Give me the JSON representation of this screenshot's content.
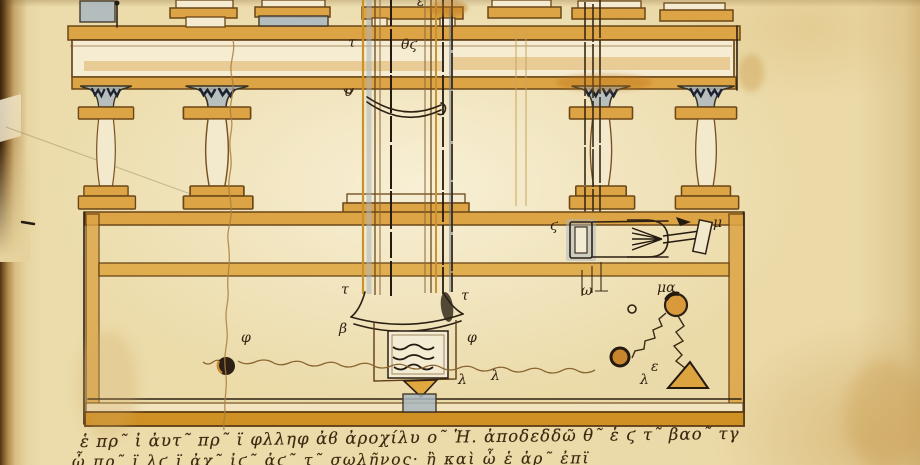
{
  "diagram_labels": [
    {
      "t": "τ",
      "x": 348,
      "y": 47
    },
    {
      "t": "θϛ",
      "x": 401,
      "y": 49
    },
    {
      "t": "ε",
      "x": 417,
      "y": 6
    },
    {
      "t": "υ",
      "x": 344,
      "y": 96
    },
    {
      "t": "ϛ",
      "x": 550,
      "y": 230
    },
    {
      "t": "μ",
      "x": 713,
      "y": 227
    },
    {
      "t": "ω",
      "x": 581,
      "y": 295
    },
    {
      "t": "μα",
      "x": 657,
      "y": 292
    },
    {
      "t": "ε",
      "x": 651,
      "y": 371
    },
    {
      "t": "λ",
      "x": 640,
      "y": 384
    },
    {
      "t": "τ",
      "x": 341,
      "y": 294
    },
    {
      "t": "β",
      "x": 339,
      "y": 333
    },
    {
      "t": "φ",
      "x": 241,
      "y": 342
    },
    {
      "t": "φ",
      "x": 467,
      "y": 342
    },
    {
      "t": "τ",
      "x": 461,
      "y": 300
    },
    {
      "t": "λ",
      "x": 458,
      "y": 384
    },
    {
      "t": "λ",
      "x": 491,
      "y": 380
    }
  ],
  "text_lines": {
    "line1": "ἑ πρ῀ ἰ ἀυτ῀ πρ῀ ϊ φλληφ ἀϐ ἀροχίλυ ο῀ Ἡ. ἀποδεδδῶ θ῀ ἑ ϛ τ῀ βαο῀ τγ",
    "line2": "ὦ πρ῀ ϊ λϛ ϊ ἀχ῀ ἰϛ῀ ἀϛ῀ τ῀ σωλῆνος· ἢ καὶ ὦ ἑ ἀρ῀ ἐπϊ"
  },
  "colors": {
    "parchment": "#e9d7a5",
    "parchment_light": "#f5ecd2",
    "gutter_dark": "#4a3115",
    "ink_sepia": "#5f3c15",
    "ink_dark": "#2c2014",
    "ochre_wash": "#dda445",
    "blue_gray_wash": "#a9b7c0",
    "text_ink": "#3d2710"
  }
}
